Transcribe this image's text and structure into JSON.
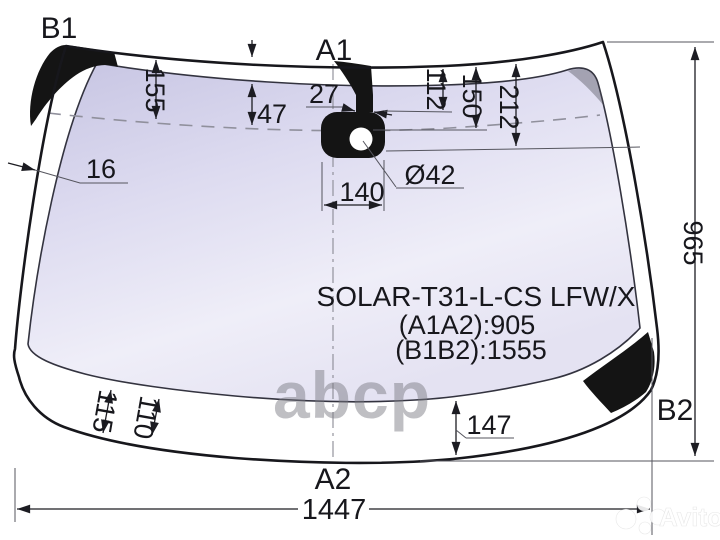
{
  "product_label": {
    "part_code": "SOLAR-T31-L-CS LFW/X",
    "dim_a1a2": "(A1A2):905",
    "dim_b1b2": "(B1B2):1555"
  },
  "point_labels": {
    "b1": "B1",
    "a1": "A1",
    "a2": "A2",
    "b2": "B2"
  },
  "measurements": {
    "frit_band_height_outer": "155",
    "frit_band_height_inner": "47",
    "sensor_stem_width": "27",
    "mount_top_offset": "112",
    "mount_center_offset": "150",
    "mount_bottom_offset": "212",
    "left_edge_width": "16",
    "mount_width": "140",
    "hole_diameter": "Ø42",
    "overall_height": "965",
    "bottom_band_left_1": "115",
    "bottom_band_left_2": "110",
    "bottom_band_right": "147",
    "overall_width": "1447"
  },
  "watermarks": {
    "parts_catalog": "abcp",
    "marketplace": "Avito"
  },
  "colors": {
    "glass_tint_edge": "#c6c4e2",
    "glass_tint_center": "#f0effa",
    "ceramic_black": "#141414",
    "line": "#17171c",
    "dashed_line": "#90909c",
    "watermark_gray": "rgba(122,122,130,0.48)"
  }
}
